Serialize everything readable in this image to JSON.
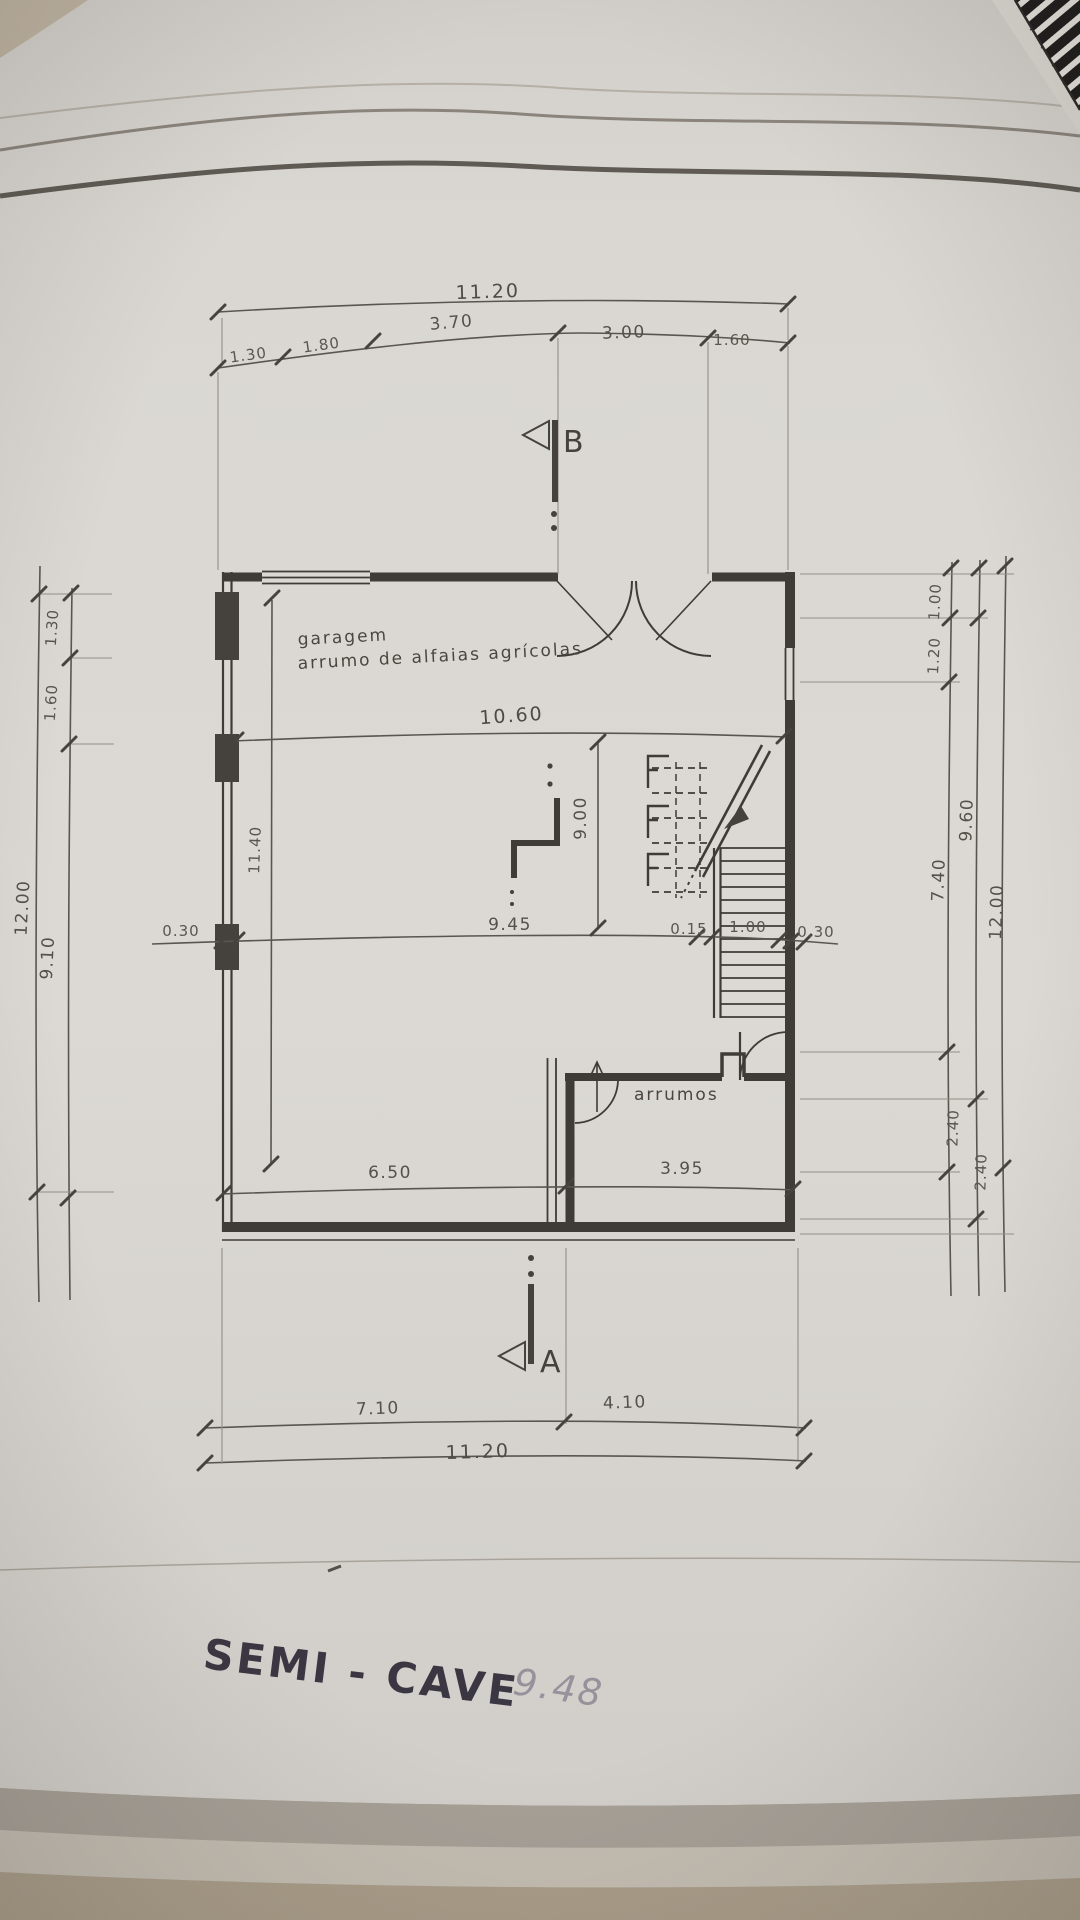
{
  "photo": {
    "colors": {
      "desk": "#b3a896",
      "paper": "#d9d6d1",
      "ink": "#45413c",
      "title_ink": "#3a3742",
      "pencil": "#96929c"
    }
  },
  "drawing": {
    "title": "SEMI - CAVE",
    "handwritten_note": "9.48",
    "rooms": {
      "garage_label_line1": "garagem",
      "garage_label_line2": "arrumo de alfaias agrícolas",
      "storage_label": "arrumos"
    },
    "sections": {
      "b": "B",
      "a": "A"
    },
    "dimensions": {
      "top_total": "11.20",
      "top_chain": [
        "1.30",
        "1.80",
        "3.70",
        "3.00",
        "1.60"
      ],
      "interior_width": "10.60",
      "interior_height": "9.00",
      "interior_left_height": "11.40",
      "mid_chain": [
        "0.30",
        "9.45",
        "0.15",
        "1.00",
        "0.30"
      ],
      "lower_chain": [
        "6.50",
        "3.95"
      ],
      "left_chain": [
        "1.30",
        "1.60",
        "9.10"
      ],
      "left_total": "12.00",
      "right_chain": [
        "1.00",
        "1.20",
        "7.40",
        "2.40"
      ],
      "right_mid_chain": [
        "9.60",
        "2.40"
      ],
      "right_total": "12.00",
      "bottom_chain": [
        "7.10",
        "4.10"
      ],
      "bottom_total": "11.20"
    }
  }
}
